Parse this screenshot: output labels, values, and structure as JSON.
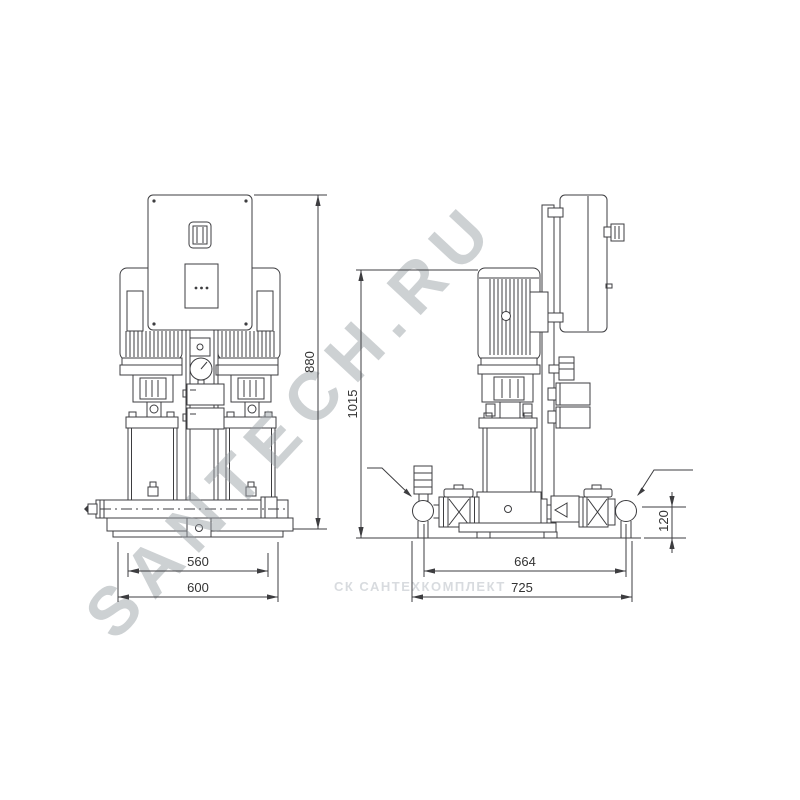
{
  "front_view": {
    "dim_height": "880",
    "dim_width_inner": "560",
    "dim_width_overall": "600"
  },
  "side_view": {
    "dim_height": "1015",
    "dim_port_distance": "664",
    "dim_depth": "725",
    "dim_port_height": "120"
  },
  "watermarks": {
    "main": "SANTECH.RU",
    "secondary": "СК САНТЕХКОМПЛЕКТ"
  }
}
